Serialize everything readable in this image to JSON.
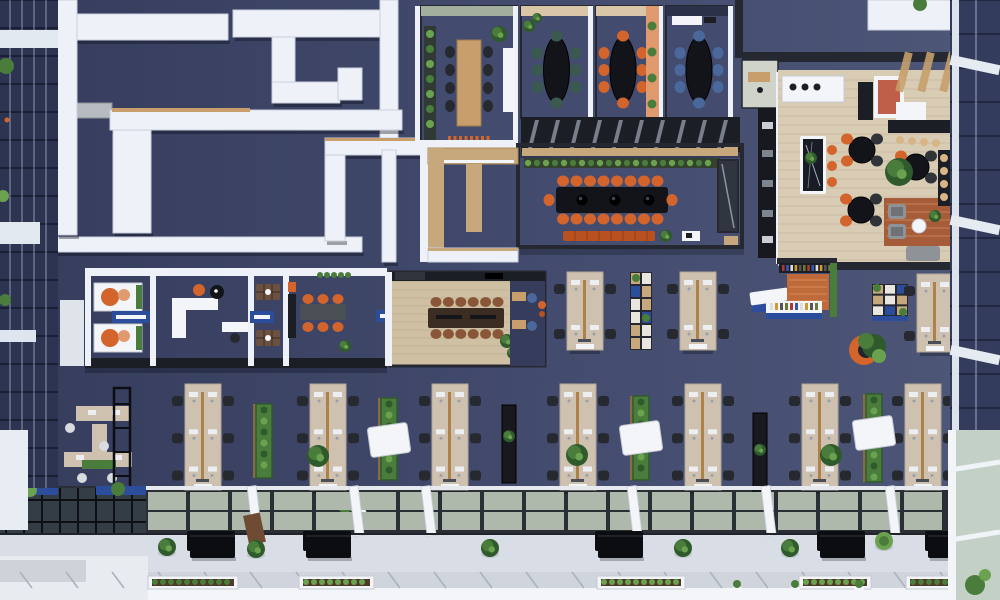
{
  "palette": {
    "floor": "#434b6e",
    "floorDark": "#353c5c",
    "floorLight": "#4e5778",
    "wall": "#eef1f7",
    "wallShade": "#c9d0de",
    "beamGray": "#b6bac1",
    "dark": "#1b1e24",
    "steel": "#252830",
    "glassDark": "#2b3149",
    "wood": "#c79e6c",
    "woodLight": "#d8b586",
    "plywood": "#c7a77c",
    "tanWall": "#d9c6a8",
    "sage": "#a3ae9f",
    "loungeFloor": "#d8ccb5",
    "plank": "#c7b89e",
    "boardFloor": "#cfc0a4",
    "tableDark": "#121419",
    "walnut": "#3c2d22",
    "orange": "#d2642c",
    "orangeDeep": "#b8511f",
    "terracotta": "#e09a6e",
    "coral": "#bf5f49",
    "blue": "#2c4d9c",
    "chairBlue": "#4a689c",
    "chairGreen": "#3a5a50",
    "chairBlack": "#26292f",
    "chairBrown": "#8a5638",
    "desk": "#cec1b0",
    "deskTrim": "#ad8148",
    "monitor": "#eceef2",
    "white": "#f3f5f8",
    "green": "#4a7c3b",
    "greenDark": "#2e5a2c",
    "greenLight": "#6ba24f",
    "planter": "#17191e",
    "skyGlass": "#aeb9ac",
    "skyGlass2": "#9aa69c",
    "frameDark": "#2a2e35",
    "walkway": "#d9dde5",
    "pave": "#cfd4dd",
    "rug": "#a65b39",
    "gray": "#8f9398",
    "lightGray": "#ced3da",
    "facade": "#2c3452",
    "facadeMullion": "#8d97ac",
    "facadeGreen": "#c3d0c5",
    "bookRed": "#a83b33",
    "bookBlue": "#3557b0",
    "bookYellow": "#d49a2e"
  },
  "scene": {
    "walls": [
      [
        60,
        14,
        168,
        26
      ],
      [
        233,
        10,
        147,
        27
      ],
      [
        272,
        37,
        23,
        46
      ],
      [
        272,
        82,
        68,
        21
      ],
      [
        338,
        68,
        24,
        32
      ],
      [
        380,
        0,
        18,
        150
      ],
      [
        110,
        110,
        292,
        20
      ],
      [
        113,
        130,
        38,
        103
      ],
      [
        8,
        237,
        354,
        15
      ],
      [
        325,
        138,
        96,
        17
      ],
      [
        325,
        155,
        20,
        86
      ],
      [
        382,
        150,
        14,
        112
      ],
      [
        57,
        0,
        20,
        235
      ]
    ],
    "deskRowsLong": [
      185,
      310,
      432,
      560,
      685,
      802,
      905
    ],
    "deskRowsShort": [
      [
        567,
        272
      ],
      [
        680,
        272
      ],
      [
        917,
        274
      ]
    ],
    "deskPlants": [
      [
        318,
        456
      ],
      [
        577,
        455
      ],
      [
        831,
        455
      ]
    ],
    "hedges": [
      [
        256,
        404,
        74
      ],
      [
        381,
        398,
        82
      ],
      [
        633,
        396,
        84
      ],
      [
        866,
        394,
        88
      ]
    ],
    "hedgePods": [
      [
        381,
        440
      ],
      [
        633,
        438
      ],
      [
        866,
        433
      ]
    ],
    "darkPlanters": [
      [
        502,
        405,
        78
      ],
      [
        753,
        413,
        92
      ]
    ],
    "benches": [
      190,
      306,
      598,
      820,
      928
    ],
    "walkwayPlants": [
      [
        167,
        547
      ],
      [
        256,
        549
      ],
      [
        490,
        548
      ],
      [
        683,
        548
      ],
      [
        790,
        548
      ],
      [
        884,
        541
      ]
    ],
    "planterBoxes": [
      [
        148,
        90
      ],
      [
        299,
        75
      ],
      [
        597,
        88
      ],
      [
        799,
        72
      ],
      [
        906,
        92
      ]
    ],
    "smallPots": [
      737,
      795,
      859,
      972
    ],
    "skylightBeams": [
      250,
      352,
      424,
      630,
      764,
      888,
      957
    ],
    "meetingRooms": [
      {
        "x": 421,
        "w": 96,
        "top": "sage",
        "table": "wood",
        "chair": "chairBlack"
      },
      {
        "x": 521,
        "w": 71,
        "top": "tanWall",
        "table": "dark",
        "chair": "chairGreen"
      },
      {
        "x": 596,
        "w": 66,
        "top": "tanWall",
        "accentRight": true,
        "table": "dark",
        "chair": "orange"
      },
      {
        "x": 666,
        "w": 66,
        "top": "glassDark",
        "table": "dark",
        "chair": "chairBlue"
      }
    ],
    "loungeTables": [
      [
        862,
        150
      ],
      [
        916,
        167
      ],
      [
        861,
        210
      ]
    ],
    "islandStools": [
      [
        832,
        150
      ],
      [
        832,
        166
      ],
      [
        832,
        182
      ]
    ],
    "barStoolsTop": [
      [
        900,
        140
      ],
      [
        912,
        141
      ],
      [
        924,
        142
      ],
      [
        936,
        143
      ]
    ],
    "barStoolsRight": [
      [
        944,
        158
      ],
      [
        944,
        171
      ],
      [
        944,
        184
      ],
      [
        944,
        197
      ]
    ],
    "confChairs": {
      "xStart": 563,
      "xStep": 13.5,
      "count": 8,
      "cyTop": 181,
      "cyBottom": 219,
      "ends": [
        [
          549,
          200
        ],
        [
          672,
          200
        ]
      ]
    },
    "boardChairs": {
      "xStart": 436,
      "xStep": 12.4,
      "count": 6,
      "cyTop": 302,
      "cyBottom": 334
    },
    "blueDoors": [
      [
        112,
        311,
        38
      ],
      [
        250,
        311,
        24
      ],
      [
        376,
        310,
        20
      ]
    ]
  }
}
